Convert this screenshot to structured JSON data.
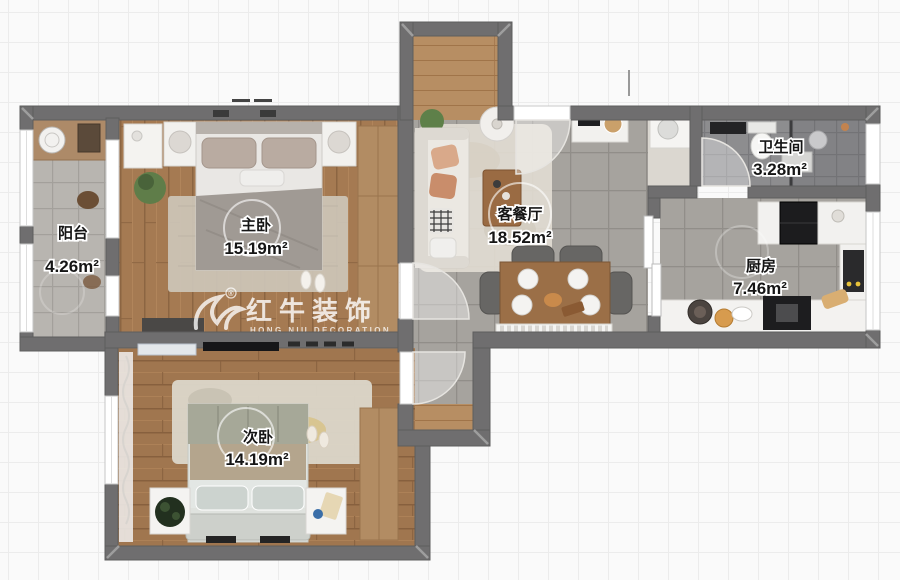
{
  "watermark": {
    "brand": "红牛装饰",
    "subtitle": "HONG NIU DECORATION",
    "registered_mark": "®"
  },
  "rooms": {
    "balcony": {
      "name": "阳台",
      "area": "4.26m²"
    },
    "master_bedroom": {
      "name": "主卧",
      "area": "15.19m²"
    },
    "second_bedroom": {
      "name": "次卧",
      "area": "14.19m²"
    },
    "living_dining": {
      "name": "客餐厅",
      "area": "18.52m²"
    },
    "bathroom": {
      "name": "卫生间",
      "area": "3.28m²"
    },
    "kitchen": {
      "name": "厨房",
      "area": "7.46m²"
    }
  },
  "colors": {
    "wall": "#6f6e6f",
    "bedroom_wood": "#a57a52",
    "entry_wood": "#b78e63",
    "living_tile": "#a6a39e",
    "bathroom_tile": "#8c8c8e",
    "balcony_tile": "#b8b5b0",
    "background": "#fafafa",
    "watermark_text": "#ffffff"
  }
}
